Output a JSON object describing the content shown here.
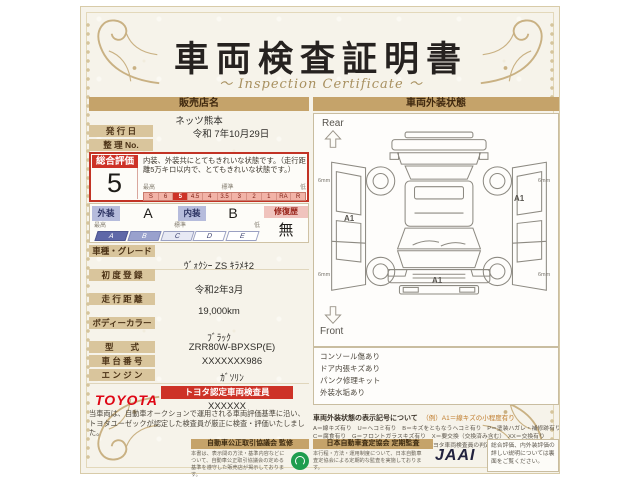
{
  "colors": {
    "accent_red": "#cd3227",
    "band_tan": "#c5a36a",
    "toyota_red": "#df0615"
  },
  "title": "車両検査証明書",
  "subtitle": "Inspection Certificate",
  "ornament_left": "～",
  "ornament_right": "～",
  "dealer": {
    "header": "販売店名",
    "name": "ネッツ熊本",
    "issue_label": "発 行 日",
    "issue_value": "令和 7年10月29日",
    "ref_label": "整 理 No.",
    "ref_value": ""
  },
  "rating": {
    "label": "総合評価",
    "value": "5",
    "description": "内装、外装共にとてもきれいな状態です。（走行距離5万キロ以内で、とてもきれいな状態です。）",
    "scale_high": "最高",
    "scale_mid": "標準",
    "scale_low": "低",
    "scale": [
      "S",
      "6",
      "5",
      "4.5",
      "4",
      "3.5",
      "3",
      "2",
      "1",
      "RA",
      "R"
    ]
  },
  "condition": {
    "exterior_label": "外装",
    "exterior_value": "A",
    "interior_label": "内装",
    "interior_value": "B",
    "repair_label": "修復歴",
    "repair_value": "無",
    "scale_high": "最高",
    "scale_mid": "標準",
    "scale_low": "低",
    "scale": [
      "A",
      "B",
      "C",
      "D",
      "E"
    ]
  },
  "specs": [
    {
      "label": "車種・グレード",
      "value": "ｳﾞｫｸｼｰ ZS ｷﾗﾒｷ2"
    },
    {
      "label": "初 度 登 録",
      "value": "令和2年3月"
    },
    {
      "label": "走 行 距 離",
      "value": "19,000km"
    },
    {
      "label": "ボディーカラー",
      "value": "ﾌﾞﾗｯｸ"
    },
    {
      "label": "型　　式",
      "value": "ZRR80W-BPXSP(E)"
    },
    {
      "label": "車 台 番 号",
      "value": "XXXXXXX986"
    },
    {
      "label": "エ ン ジ ン",
      "value": "ｶﾞｿﾘﾝ"
    }
  ],
  "inspector": {
    "brand": "TOYOTA",
    "band": "トヨタ認定車両検査員",
    "id": "XXXXXX"
  },
  "disclaimer": "当車両は、自動車オークションで運用される車両評価基準に沿い、トヨタユーゼックが認定した検査員が厳正に検査・評価いたしました。",
  "exterior_panel": {
    "header": "車両外装状態",
    "rear_label": "Rear",
    "front_label": "Front",
    "mark_left": "A1",
    "mark_right": "A1",
    "mark_front": "A1",
    "tire_depth": "6mm",
    "notes": [
      "コンソール傷あり",
      "ドア内張キズあり",
      "パンク修理キット",
      "外装水垢あり"
    ],
    "legend_title": "車両外装状態の表示記号について",
    "legend_example": "（例）A1＝線キズの小程度有り",
    "legend_lines": [
      "A＝線キズ有り　U＝ヘコミ有り　B＝キズをともなうヘコミ有り　P＝塗装ハガレ・補修跡有り　S＝サビ有り",
      "C＝腐食有り　G＝フロントガラスキズ有り　X＝要交換（交換済み含む）　XX＝交換有り",
      "1＝小程度　2＝中程度　3＝中程度以上　・トヨタ車両検査員の判定により表示をしています。"
    ]
  },
  "footer": {
    "fair_trade_header": "自動車公正取引協議会 監修",
    "fair_trade_text": "本書は、表示間の方法・基準内容などについて、自動車公正取引協議会の定める基準を遵守した販売店が掲示しております。",
    "jaai_header": "日本自動車査定協会 定期監査",
    "jaai_text": "本行程・方法・運用制度について、日本自動車査定協会による定期的な監査を実施しております。",
    "jaai_logo": "JAAI",
    "backside_note": "総合評価、内外装評価の詳しい説明については裏面をご覧ください。"
  }
}
